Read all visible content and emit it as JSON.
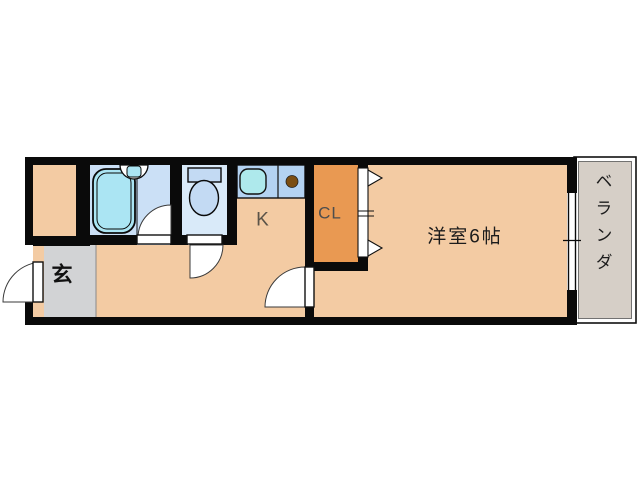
{
  "plan": {
    "type": "apartment-floorplan",
    "labels": {
      "entrance": "玄",
      "kitchen": "K",
      "closet": "CL",
      "western_room": "洋室6帖",
      "veranda": "ベランダ"
    },
    "colors": {
      "background": "#ffffff",
      "wall": "#0a0a0a",
      "floor": "#f3cba3",
      "closet": "#e99952",
      "counter": "#b4d3f2",
      "kitchen_sink": "#aee9ec",
      "bathroom_floor": "#cbe0f6",
      "bathtub": "#abe5f3",
      "toilet_floor": "#d9eaf9",
      "toilet_fixture": "#c3daf3",
      "burner": "#7b4e13",
      "entrance_floor": "#d2d3d5",
      "veranda_floor": "#d6cfc7"
    }
  }
}
